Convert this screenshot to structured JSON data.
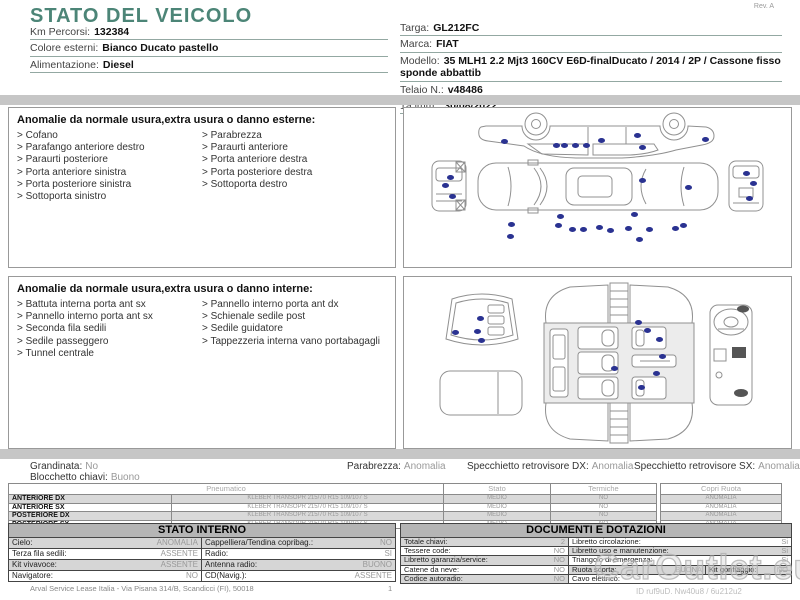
{
  "header": {
    "title": "STATO DEL VEICOLO",
    "rev": "Rev. A",
    "km": {
      "label": "Km Percorsi:",
      "value": "132384"
    },
    "colore": {
      "label": "Colore esterni:",
      "value": "Bianco Ducato pastello"
    },
    "alimentazione": {
      "label": "Alimentazione:",
      "value": "Diesel"
    },
    "targa": {
      "label": "Targa:",
      "value": "GL212FC"
    },
    "marca": {
      "label": "Marca:",
      "value": "FIAT"
    },
    "modello": {
      "label": "Modello:",
      "value": "35 MLH1 2.2 Mjt3 160CV E6D-finalDucato / 2014 / 2P / Cassone fisso sponde abbattib"
    },
    "telaio": {
      "label": "Telaio N.:",
      "value": "v48486"
    },
    "imm": {
      "label": "1a imm.:",
      "value": "30/08/2022"
    }
  },
  "exterior_section": {
    "title": "Anomalie da normale usura,extra usura o danno esterne:",
    "items_left": [
      "Cofano",
      "Parafango anteriore destro",
      "Paraurti posteriore",
      "Porta anteriore sinistra",
      "Porta posteriore sinistra",
      "Sottoporta sinistro"
    ],
    "items_right": [
      "Parabrezza",
      "Paraurti anteriore",
      "Porta anteriore destra",
      "Porta posteriore destra",
      "Sottoporta destro"
    ]
  },
  "interior_section": {
    "title": "Anomalie da normale usura,extra usura o danno interne:",
    "items_left": [
      "Battuta interna porta ant sx",
      "Pannello interno porta ant sx",
      "Seconda fila sedili",
      "Sedile passeggero",
      "Tunnel centrale"
    ],
    "items_right": [
      "Pannello interno porta ant dx",
      "Schienale sedile post",
      "Sedile guidatore",
      "Tappezzeria interna vano portabagagli"
    ]
  },
  "summary": {
    "grandinata": {
      "label": "Grandinata:",
      "value": "No"
    },
    "blocchetto": {
      "label": "Blocchetto chiavi:",
      "value": "Buono"
    },
    "parabrezza": {
      "label": "Parabrezza:",
      "value": "Anomalia"
    },
    "specchietto_dx": {
      "label": "Specchietto retrovisore DX:",
      "value": "Anomalia"
    },
    "specchietto_sx": {
      "label": "Specchietto retrovisore SX:",
      "value": "Anomalia"
    }
  },
  "tires": {
    "header_pneumatico": "Pneumatico",
    "header_stato": "Stato",
    "header_termiche": "Termiche",
    "header_copri": "Copri Ruota",
    "rows": [
      {
        "position": "ANTERIORE DX",
        "tire": "KLEBER TRANSOPR 215/70 R15 109/107 S",
        "stato": "MEDIO",
        "termiche": "NO",
        "copri": "ANOMALIA"
      },
      {
        "position": "ANTERIORE SX",
        "tire": "KLEBER TRANSOPR 215/70 R15 109/107 S",
        "stato": "MEDIO",
        "termiche": "NO",
        "copri": "ANOMALIA"
      },
      {
        "position": "POSTERIORE DX",
        "tire": "KLEBER TRANSOPR 215/70 R15 109/107 S",
        "stato": "MEDIO",
        "termiche": "NO",
        "copri": "ANOMALIA"
      },
      {
        "position": "POSTERIORE SX",
        "tire": "KLEBER TRANSOPR 215/70 R15 109/107 S",
        "stato": "MEDIO",
        "termiche": "NO",
        "copri": "ANOMALIA"
      }
    ]
  },
  "stato_interno": {
    "title": "STATO INTERNO",
    "rows": [
      {
        "l": {
          "label": "Cielo:",
          "value": "ANOMALIA"
        },
        "r": {
          "label": "Cappelliera/Tendina copribag.:",
          "value": "NO"
        }
      },
      {
        "l": {
          "label": "Terza fila sedili:",
          "value": "ASSENTE"
        },
        "r": {
          "label": "Radio:",
          "value": "SI"
        }
      },
      {
        "l": {
          "label": "Kit vivavoce:",
          "value": "ASSENTE"
        },
        "r": {
          "label": "Antenna radio:",
          "value": "BUONO"
        }
      },
      {
        "l": {
          "label": "Navigatore:",
          "value": "NO"
        },
        "r": {
          "label": "CD(Navig.):",
          "value": "ASSENTE"
        }
      }
    ]
  },
  "documenti": {
    "title": "DOCUMENTI E DOTAZIONI",
    "rows": [
      {
        "l": {
          "label": "Totale chiavi:",
          "value": "2"
        },
        "r": {
          "label": "Libretto circolazione:",
          "value": "Si"
        }
      },
      {
        "l": {
          "label": "Tessere code:",
          "value": "NO"
        },
        "r": {
          "label": "Libretto uso e manutenzione:",
          "value": "Si"
        }
      },
      {
        "l": {
          "label": "Libretto garanzia/service:",
          "value": "NO"
        },
        "r": {
          "label": "Triangolo di emergenza:",
          "value": "Si"
        }
      },
      {
        "l": {
          "label": "Catene da neve:",
          "value": "NO"
        },
        "r": {
          "label": "Ruota scorta:",
          "value": "BUONA"
        },
        "r2": {
          "label": "Kit gonfiaggio:",
          "value": "NO"
        }
      },
      {
        "l": {
          "label": "Codice autoradio:",
          "value": "NO"
        },
        "r": {
          "label": "Cavo elettrico:",
          "value": ""
        }
      }
    ]
  },
  "footer": {
    "company": "Arval Service Lease Italia - Via Pisana 314/B, Scandicci (FI), 50018",
    "page": "1",
    "watermark": "CarOutlet.eu",
    "watermark_id": "ID ruf9uD. Nw40u8 / 6u212u2"
  },
  "diagram": {
    "dot_color": "#2a3291",
    "exterior_dots": [
      [
        100,
        33
      ],
      [
        152,
        37
      ],
      [
        160,
        37
      ],
      [
        171,
        37
      ],
      [
        182,
        37
      ],
      [
        197,
        32
      ],
      [
        233,
        27
      ],
      [
        238,
        39
      ],
      [
        301,
        31
      ],
      [
        238,
        72
      ],
      [
        284,
        79
      ],
      [
        46,
        69
      ],
      [
        41,
        77
      ],
      [
        48,
        88
      ],
      [
        342,
        65
      ],
      [
        349,
        75
      ],
      [
        345,
        90
      ],
      [
        107,
        116
      ],
      [
        106,
        128
      ],
      [
        154,
        117
      ],
      [
        156,
        108
      ],
      [
        168,
        121
      ],
      [
        179,
        121
      ],
      [
        195,
        119
      ],
      [
        206,
        122
      ],
      [
        224,
        120
      ],
      [
        230,
        106
      ],
      [
        235,
        131
      ],
      [
        245,
        121
      ],
      [
        271,
        120
      ],
      [
        279,
        117
      ]
    ],
    "interior_dots": [
      [
        76,
        41
      ],
      [
        51,
        55
      ],
      [
        73,
        54
      ],
      [
        77,
        63
      ],
      [
        234,
        45
      ],
      [
        243,
        53
      ],
      [
        255,
        62
      ],
      [
        258,
        79
      ],
      [
        210,
        91
      ],
      [
        252,
        96
      ],
      [
        237,
        110
      ]
    ]
  }
}
